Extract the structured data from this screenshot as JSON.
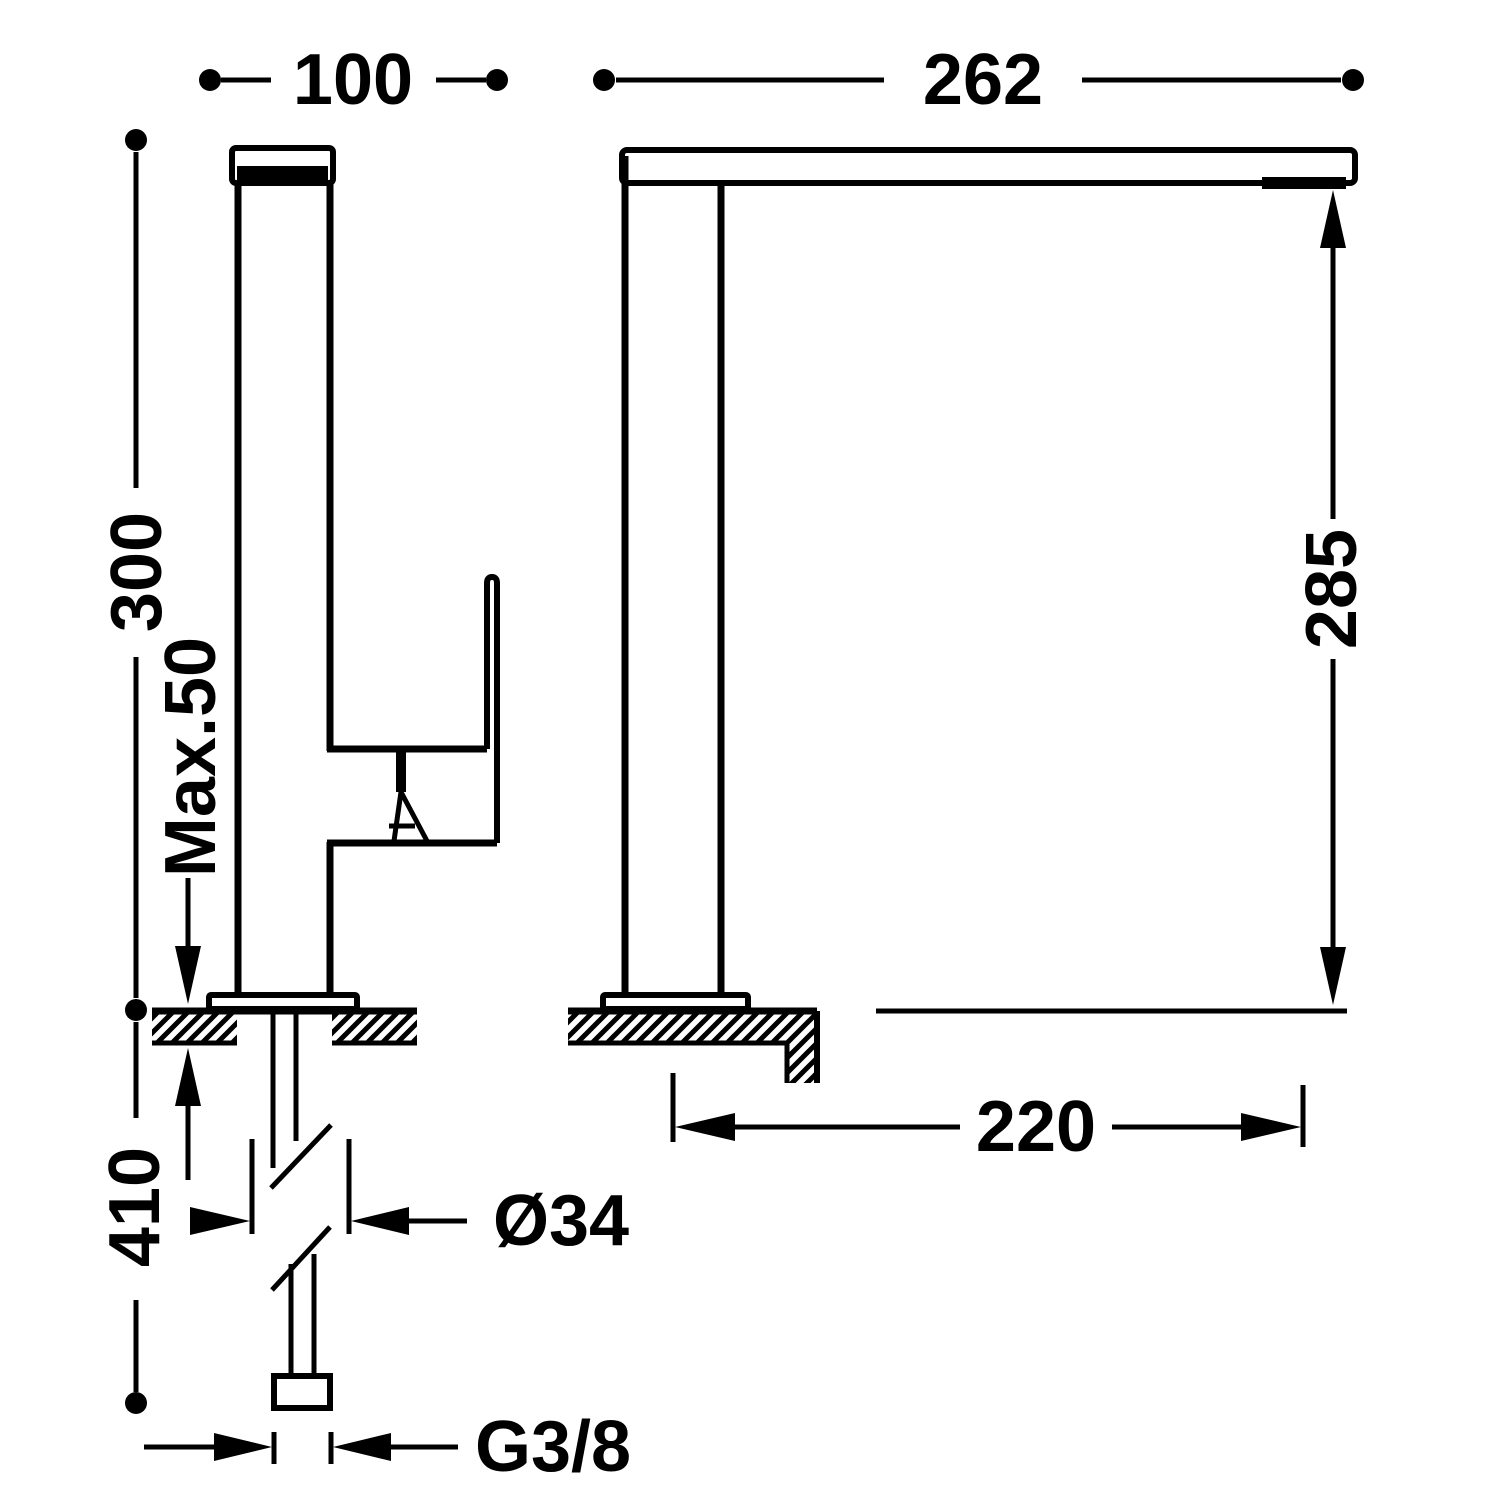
{
  "drawing": {
    "type": "technical-dimension-diagram",
    "subject": "single-lever kitchen sink faucet, front and side elevation",
    "colors": {
      "line": "#000000",
      "background": "#ffffff"
    },
    "dimensions": {
      "width_front": "100",
      "spout_overall": "262",
      "height_above_deck": "300",
      "max_deck": "Max.50",
      "spout_clearance": "285",
      "below_deck": "410",
      "spout_reach": "220",
      "shank_diameter": "Ø34",
      "supply_thread": "G3/8"
    }
  }
}
